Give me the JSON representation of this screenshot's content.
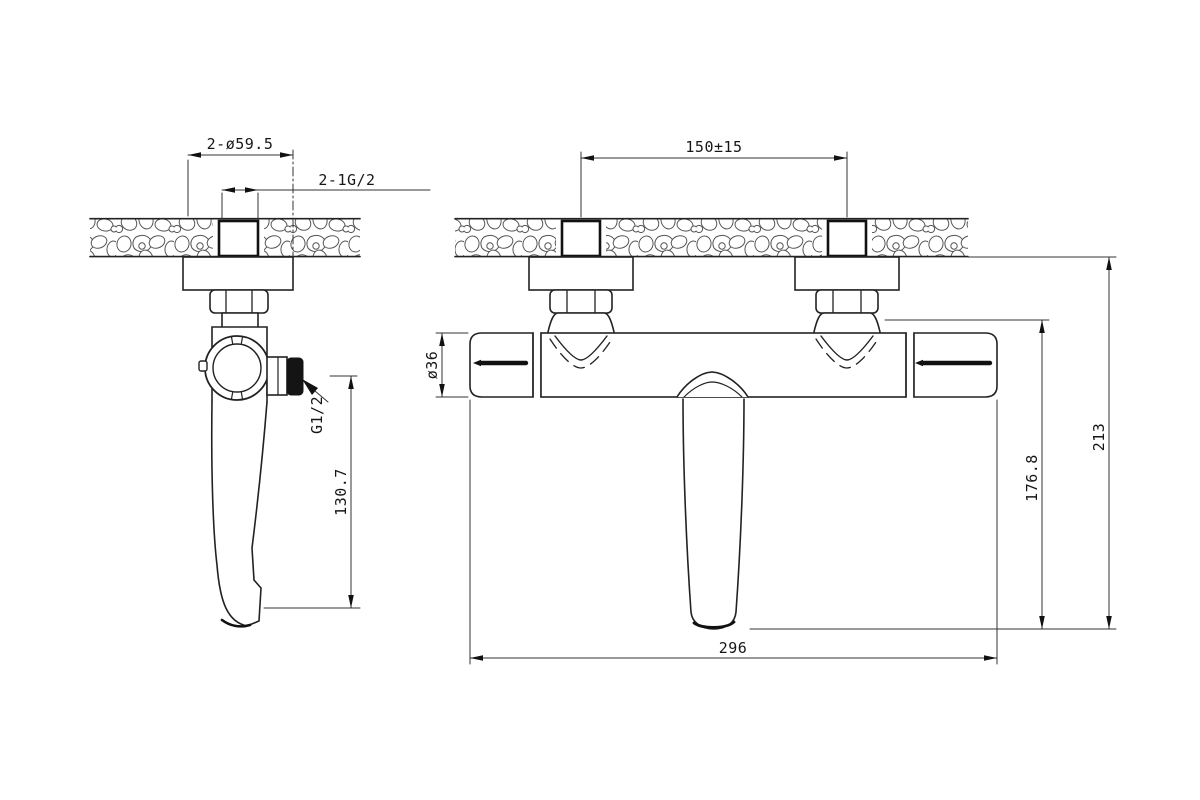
{
  "drawing": {
    "type": "technical-dimension-drawing",
    "subject": "wall-mounted thermostatic bath mixer",
    "line_color": "#222222",
    "background": "#ffffff",
    "side_view": {
      "labels": {
        "flange_pair_diameter": "2-ø59.5",
        "inlet_thread_pair": "2-1G/2",
        "outlet_thread": "G1/2",
        "spout_drop_height": "130.7"
      }
    },
    "front_view": {
      "labels": {
        "inlet_spacing": "150±15",
        "body_diameter": "ø36",
        "center_to_spout_height": "176.8",
        "overall_height": "213",
        "overall_width": "296"
      }
    }
  }
}
